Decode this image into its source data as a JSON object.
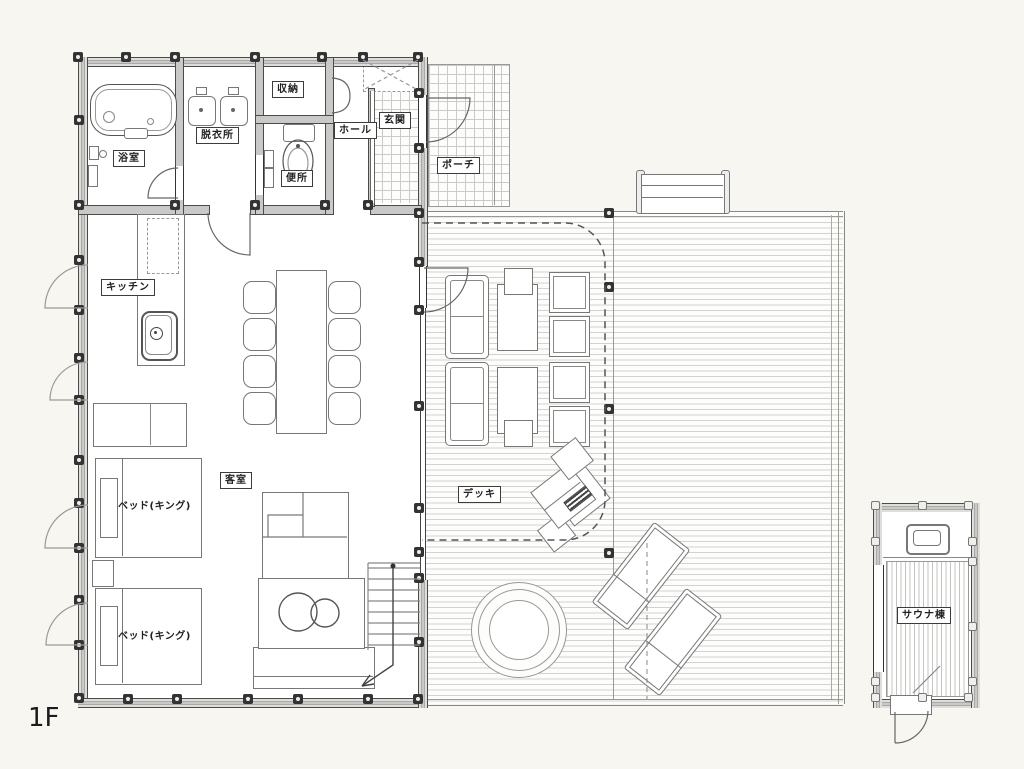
{
  "floor_label": "1F",
  "rooms": {
    "bath": "浴室",
    "dressing": "脱衣所",
    "storage": "収納",
    "toilet": "便所",
    "hall": "ホール",
    "entrance": "玄関",
    "porch": "ポーチ",
    "kitchen": "キッチン",
    "guest_room": "客室",
    "bed_king": "ベッド(キング)",
    "deck": "デッキ",
    "sauna": "サウナ棟"
  },
  "colors": {
    "background": "#f8f6f1",
    "wall_fill": "#c9c9c7",
    "wall_edge": "#4b4b4b",
    "line": "#555555",
    "deck_board": "#d2d2cf",
    "tile_line": "#cccbc7"
  }
}
